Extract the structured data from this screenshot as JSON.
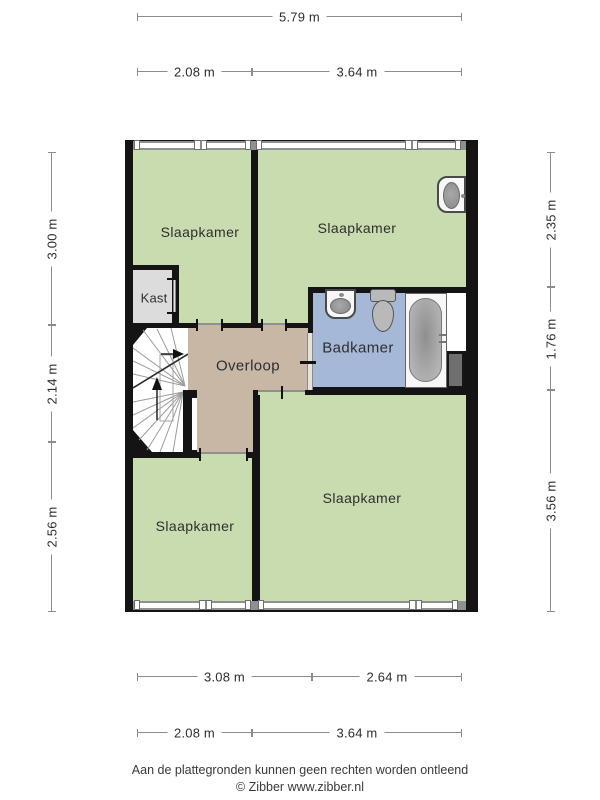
{
  "page": {
    "footer_line1": "Aan de plattegronden kunnen geen rechten worden ontleend",
    "footer_line2": "© Zibber www.zibber.nl"
  },
  "rooms": {
    "bedroom_top_left": "Slaapkamer",
    "bedroom_top_right": "Slaapkamer",
    "closet": "Kast",
    "landing": "Overloop",
    "bathroom": "Badkamer",
    "bedroom_bottom_left": "Slaapkamer",
    "bedroom_bottom_right": "Slaapkamer"
  },
  "dimensions": {
    "top_total": [
      "5.79 m"
    ],
    "top_sections": [
      "2.08 m",
      "3.64 m"
    ],
    "bottom_sections_inner": [
      "3.08 m",
      "2.64 m"
    ],
    "bottom_sections_outer": [
      "2.08 m",
      "3.64 m"
    ],
    "left_sections": [
      "3.00 m",
      "2.14 m",
      "2.56 m"
    ],
    "right_sections": [
      "2.35 m",
      "1.76 m",
      "3.56 m"
    ]
  },
  "fixtures": {
    "bedroom_washbasin": "washbasin-icon",
    "bathroom_sink": "sink-icon",
    "toilet": "toilet-icon",
    "bathtub": "bathtub-icon",
    "stairs": "stairs-icon",
    "duct": "duct-block"
  },
  "colors": {
    "wall": "#141414",
    "room_green": "#c9dcb0",
    "landing_tan": "#c8b7a5",
    "bathroom_blue": "#a6b8d8",
    "closet_gray": "#dcdcdc",
    "window_gray": "#909090",
    "duct_gray": "#6f6f6f"
  }
}
